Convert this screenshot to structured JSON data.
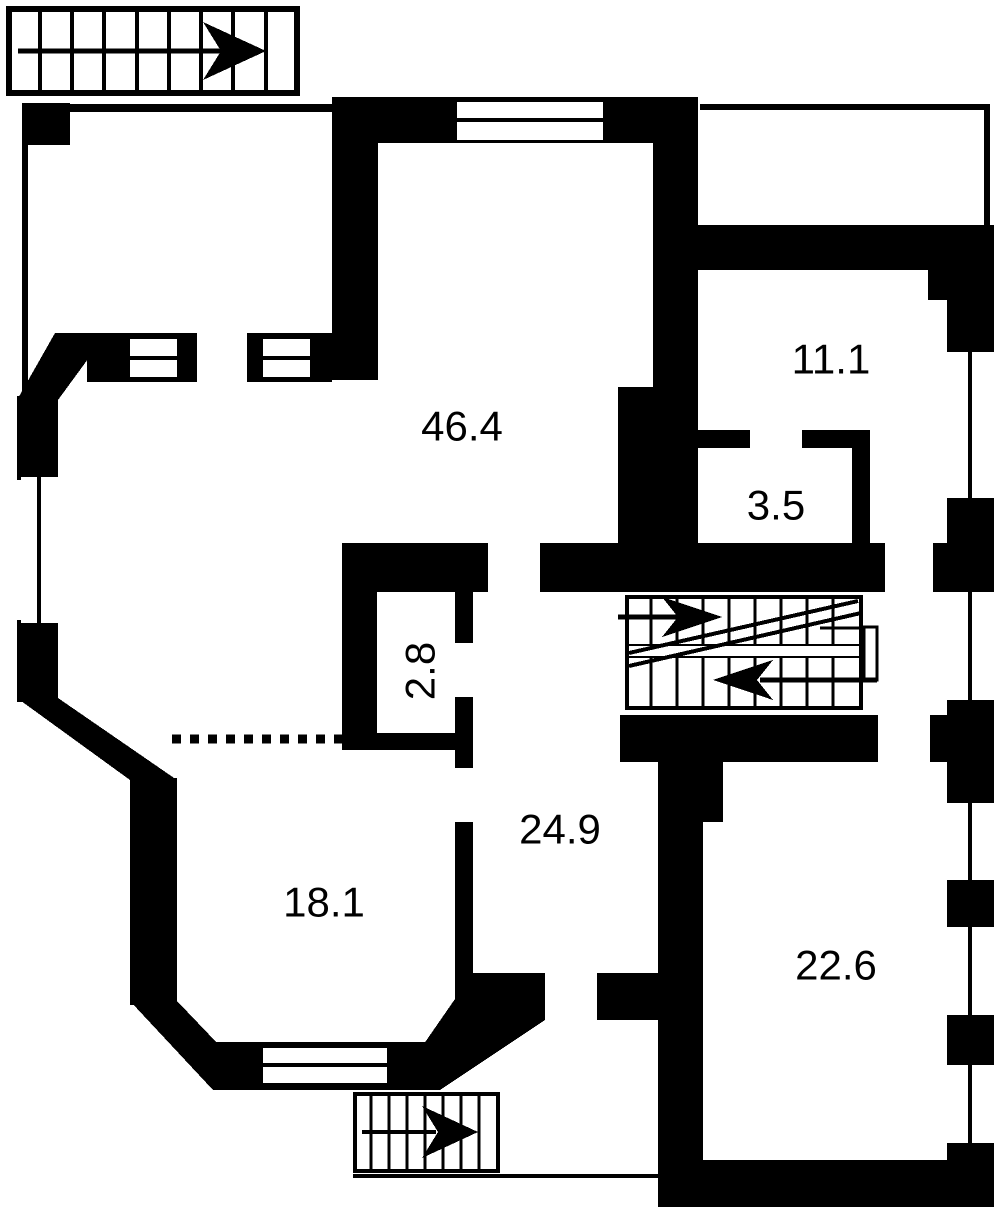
{
  "palette": {
    "wall": "#000000",
    "floor": "#ffffff"
  },
  "rooms": [
    {
      "id": "room-top-center",
      "label": "46.4"
    },
    {
      "id": "room-top-right",
      "label": "11.1"
    },
    {
      "id": "room-small-right",
      "label": "3.5"
    },
    {
      "id": "closet",
      "label": "2.8"
    },
    {
      "id": "hallway",
      "label": "24.9"
    },
    {
      "id": "room-bottom-left",
      "label": "18.1"
    },
    {
      "id": "room-bottom-right",
      "label": "22.6"
    }
  ],
  "stairs": {
    "top_left": {
      "direction": "right"
    },
    "central_upper": {
      "direction": "right"
    },
    "central_lower": {
      "direction": "left"
    },
    "bottom": {
      "direction": "right"
    }
  },
  "divider": {
    "style": "dotted"
  }
}
